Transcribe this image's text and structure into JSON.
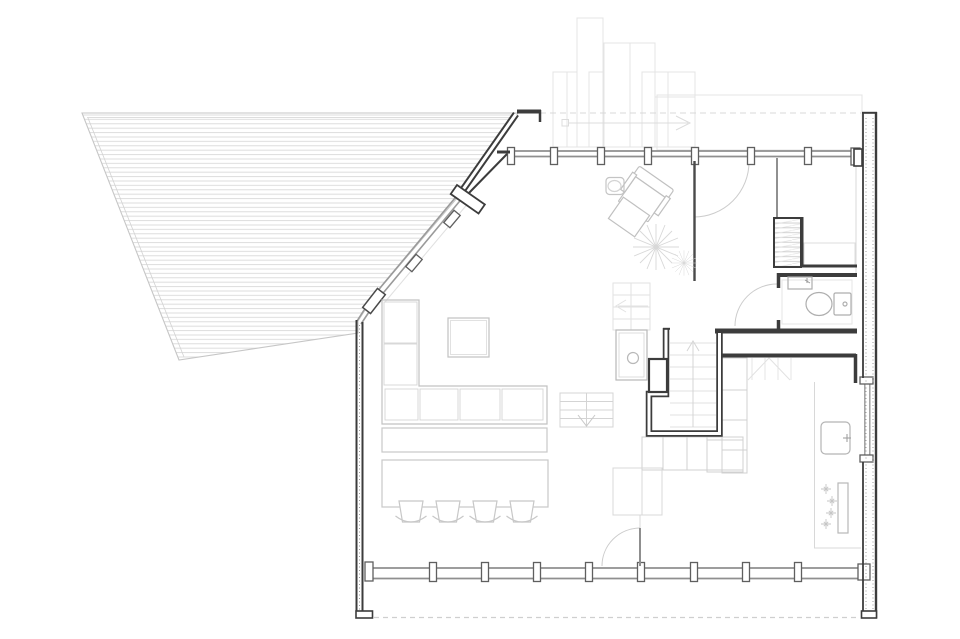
{
  "canvas": {
    "width": 960,
    "height": 639,
    "background": "#ffffff"
  },
  "drawing": {
    "kind": "architectural floor plan",
    "visible_text": ""
  },
  "colors": {
    "wall_dark": "#3c3c3c",
    "window_frame": "#8f8f8f",
    "mullion": "#5f5f5f",
    "furniture": "#c2c2c2",
    "fixture": "#aeaeae",
    "overlay_faint": "#e4e4e4",
    "faint_line": "#d6d6d6",
    "deck_hatch": "#dadada",
    "door_arc": "#cccccc"
  },
  "inventory": {
    "bar_stools": 4,
    "armchairs": 1,
    "ottomans": 1,
    "plants": 2,
    "toilets": 1,
    "sinks": 3,
    "staircase_flights": 3,
    "door_swings": 4,
    "top_window_mullions": 7,
    "bottom_window_mullions": 8
  }
}
